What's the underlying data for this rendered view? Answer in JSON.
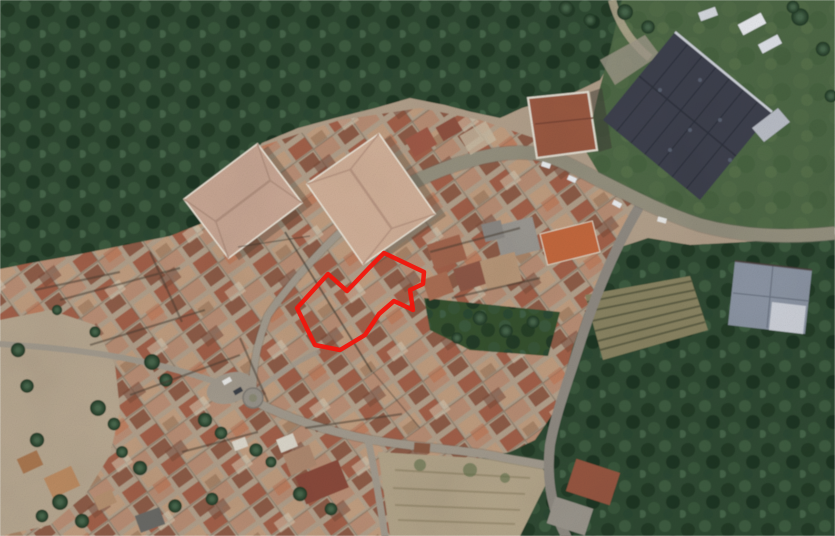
{
  "scene": {
    "type": "satellite-aerial-photo",
    "subject": "Aerial satellite view of a hillside village with dense terracotta rooftops surrounded by dark woodland; a red outline highlights a property boundary in the village centre",
    "canvas": {
      "width": 835,
      "height": 536
    },
    "palette": {
      "ground": "#b2a08b",
      "forest": "#2e4a32",
      "grass": "#4d6845",
      "road_major": "#94907e",
      "road_minor": "#a39b8e",
      "industrial_roof": "#3c414e",
      "metal_roof": "#8b94a3",
      "boundary": "#f2150c"
    },
    "property_boundary": {
      "color": "#f2150c",
      "stroke_width": 4.5,
      "points": "384,253 424,272 423,284 410,290 413,310 394,301 379,314 365,335 340,350 315,345 297,308 328,274 347,291 369,268"
    },
    "features": [
      "woodland",
      "village-rooftops",
      "main-road",
      "roundabout",
      "industrial-warehouse",
      "metal-roof-shed",
      "vineyard-rows",
      "terraced-gardens",
      "olive-grove",
      "property-boundary"
    ]
  }
}
